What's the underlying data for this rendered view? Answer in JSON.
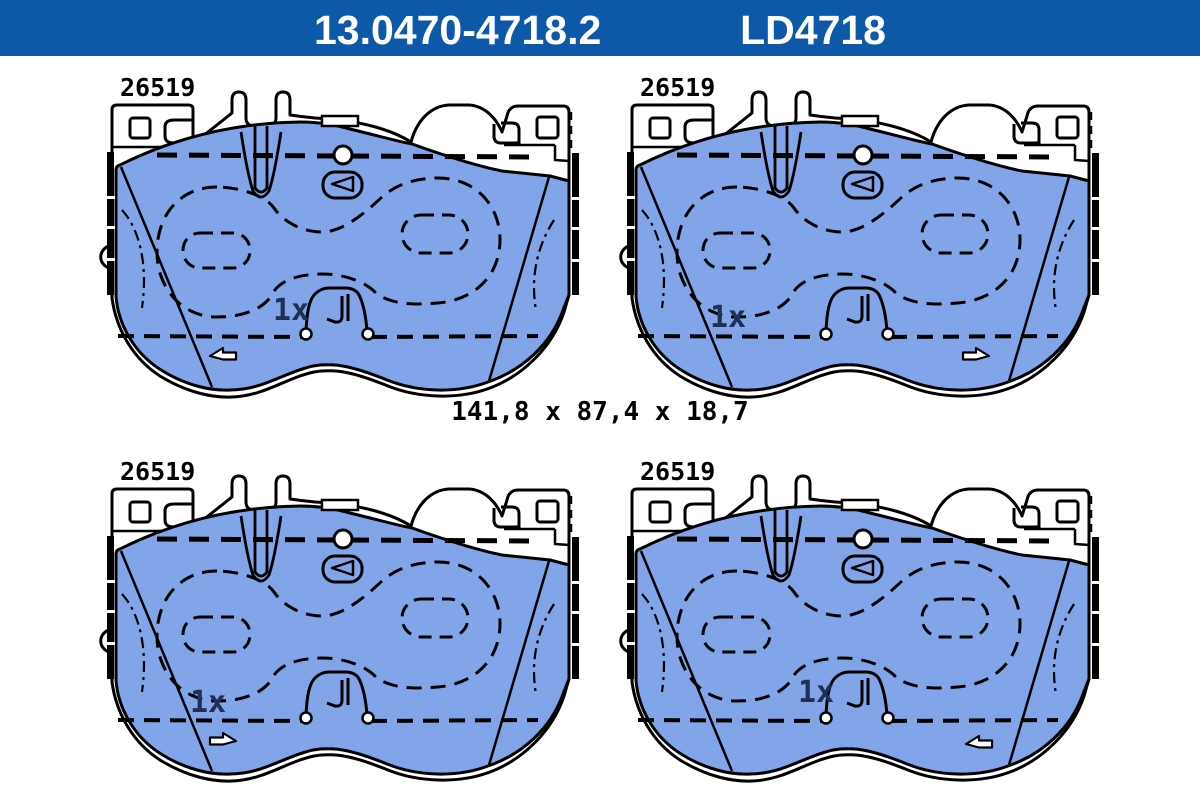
{
  "header": {
    "part_number": "13.0470-4718.2",
    "variant_code": "LD4718",
    "background_color": "#0d59a8",
    "text_color": "#ffffff"
  },
  "drawing": {
    "background_color": "#ffffff",
    "outline_color": "#000000",
    "pad_fill_color": "#82a4e8",
    "quantity_text_color": "#1e3055",
    "dimension_label": "141,8 x 87,4 x 18,7",
    "pads": [
      {
        "position": "top-left",
        "label": "26519",
        "quantity": "1x",
        "arrow_direction": "left"
      },
      {
        "position": "top-right",
        "label": "26519",
        "quantity": "1x",
        "arrow_direction": "right"
      },
      {
        "position": "bottom-left",
        "label": "26519",
        "quantity": "1x",
        "arrow_direction": "right"
      },
      {
        "position": "bottom-right",
        "label": "26519",
        "quantity": "1x",
        "arrow_direction": "left"
      }
    ]
  }
}
